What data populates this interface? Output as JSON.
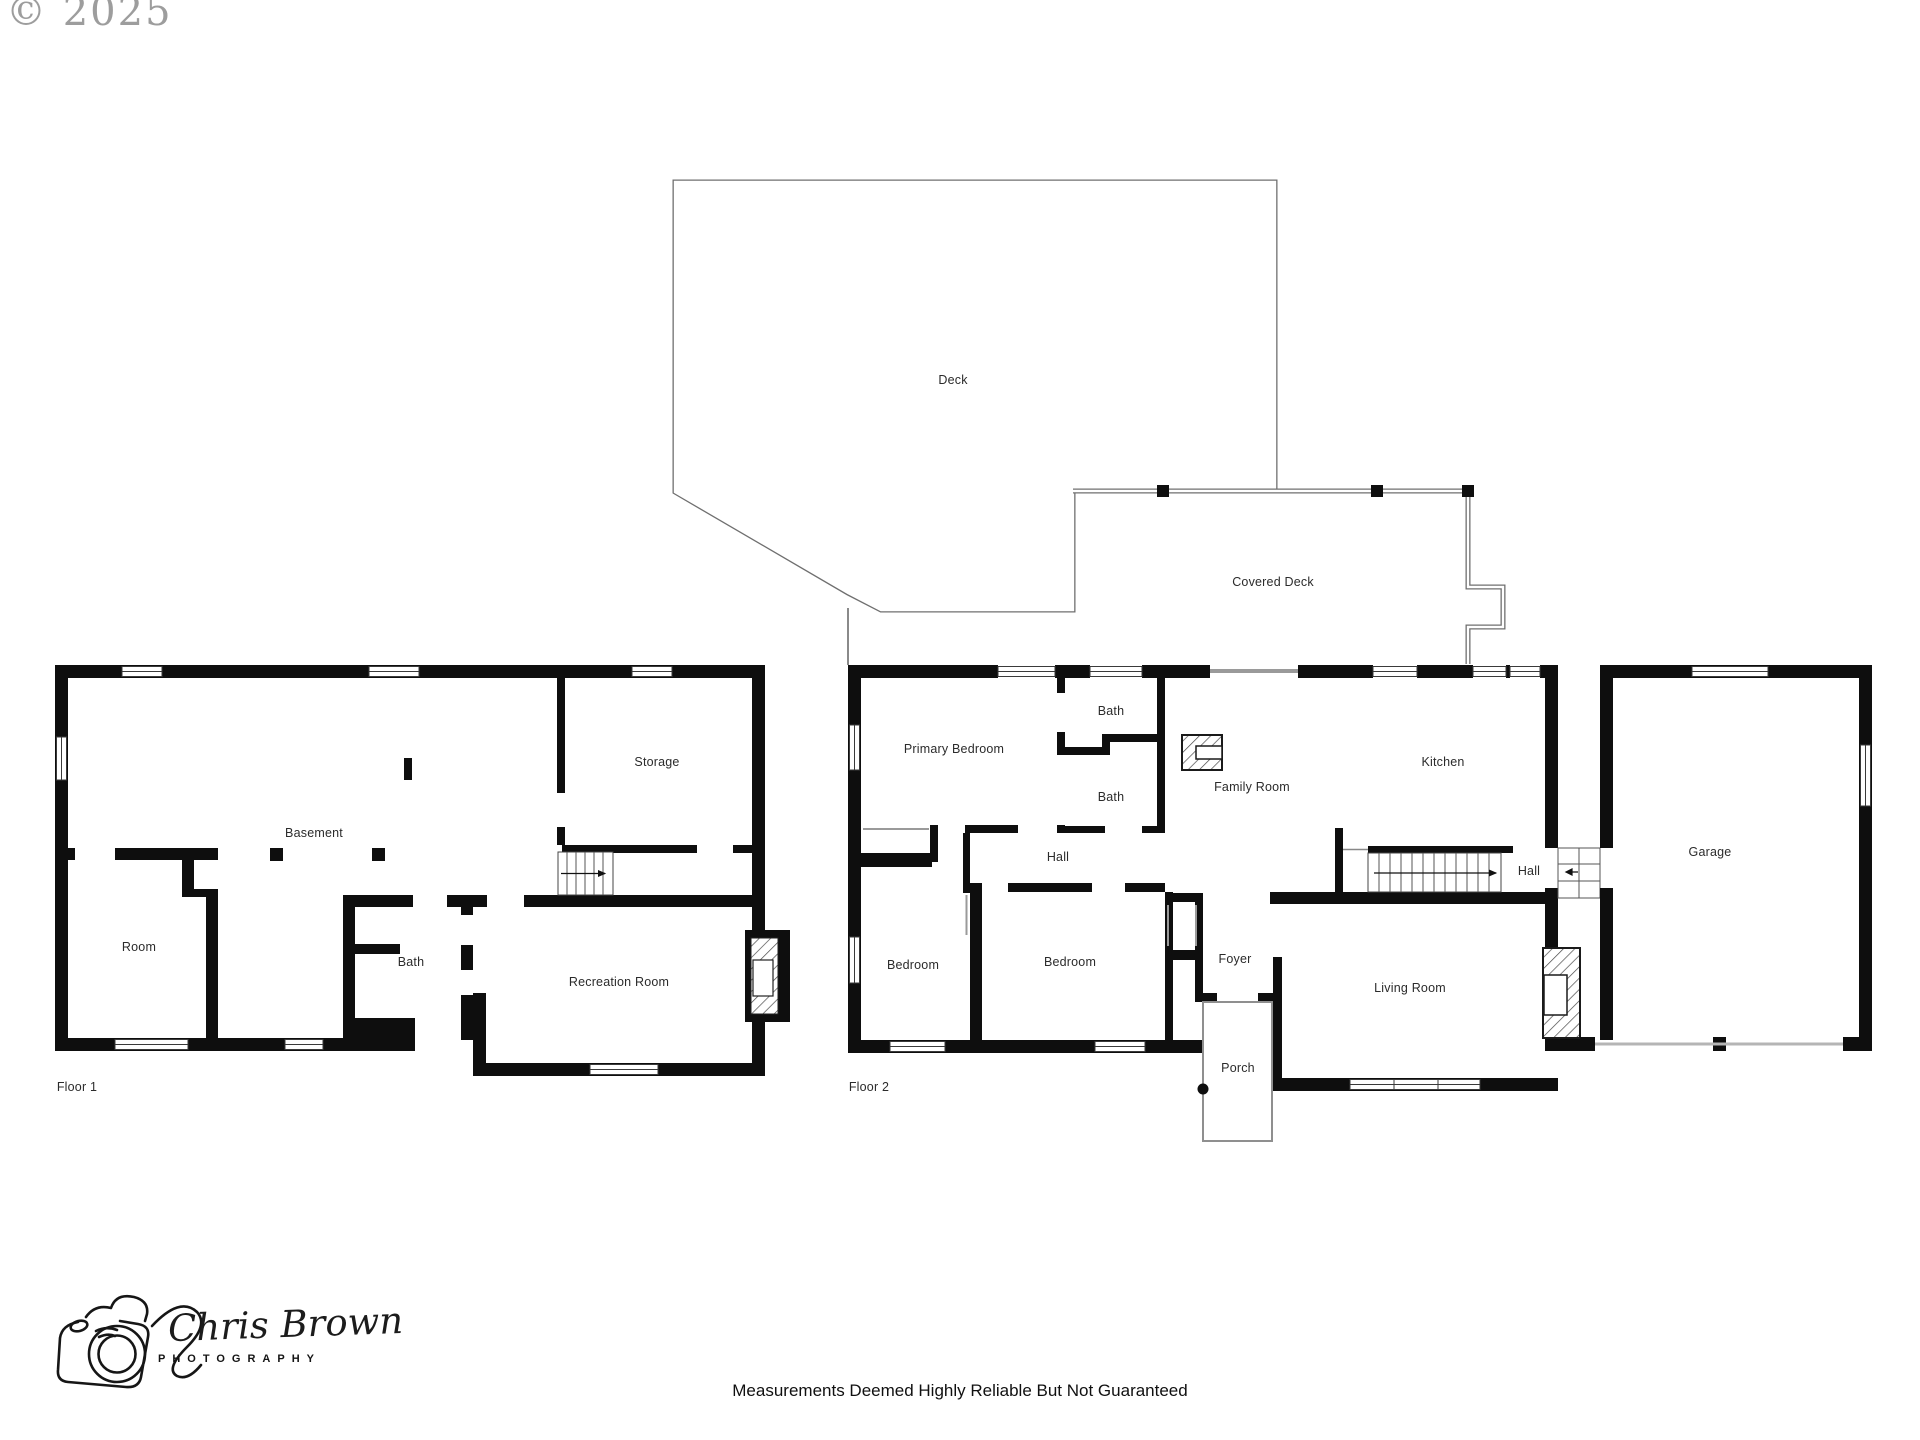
{
  "watermark": {
    "text": "© 2025",
    "color": "#8d8d8d"
  },
  "plan": {
    "wall_color": "#0e0e0e",
    "floors": [
      "Floor 1",
      "Floor 2"
    ],
    "labels": [
      {
        "text": "Deck",
        "x": 953,
        "y": 380,
        "area": "outdoor"
      },
      {
        "text": "Covered Deck",
        "x": 1273,
        "y": 582,
        "area": "outdoor"
      },
      {
        "text": "Storage",
        "x": 657,
        "y": 762,
        "area": "floor1"
      },
      {
        "text": "Basement",
        "x": 314,
        "y": 833,
        "area": "floor1"
      },
      {
        "text": "Room",
        "x": 139,
        "y": 947,
        "area": "floor1"
      },
      {
        "text": "Bath",
        "x": 411,
        "y": 962,
        "area": "floor1"
      },
      {
        "text": "Recreation Room",
        "x": 619,
        "y": 982,
        "area": "floor1"
      },
      {
        "text": "Floor 1",
        "x": 77,
        "y": 1087,
        "area": "floor1-title"
      },
      {
        "text": "Primary Bedroom",
        "x": 954,
        "y": 749,
        "area": "floor2"
      },
      {
        "text": "Bath",
        "x": 1111,
        "y": 711,
        "area": "floor2"
      },
      {
        "text": "Bath",
        "x": 1111,
        "y": 797,
        "area": "floor2"
      },
      {
        "text": "Family Room",
        "x": 1252,
        "y": 787,
        "area": "floor2"
      },
      {
        "text": "Kitchen",
        "x": 1443,
        "y": 762,
        "area": "floor2"
      },
      {
        "text": "Hall",
        "x": 1058,
        "y": 857,
        "area": "floor2"
      },
      {
        "text": "Hall",
        "x": 1529,
        "y": 871,
        "area": "floor2"
      },
      {
        "text": "Bedroom",
        "x": 913,
        "y": 965,
        "area": "floor2"
      },
      {
        "text": "Bedroom",
        "x": 1070,
        "y": 962,
        "area": "floor2"
      },
      {
        "text": "Foyer",
        "x": 1235,
        "y": 959,
        "area": "floor2"
      },
      {
        "text": "Porch",
        "x": 1238,
        "y": 1068,
        "area": "floor2"
      },
      {
        "text": "Living Room",
        "x": 1410,
        "y": 988,
        "area": "floor2"
      },
      {
        "text": "Garage",
        "x": 1710,
        "y": 852,
        "area": "floor2"
      },
      {
        "text": "Floor 2",
        "x": 869,
        "y": 1087,
        "area": "floor2-title"
      }
    ]
  },
  "footer": {
    "disclaimer": "Measurements Deemed Highly Reliable But Not Guaranteed"
  },
  "logo": {
    "name": "Chris Brown",
    "subtitle": "PHOTOGRAPHY"
  }
}
